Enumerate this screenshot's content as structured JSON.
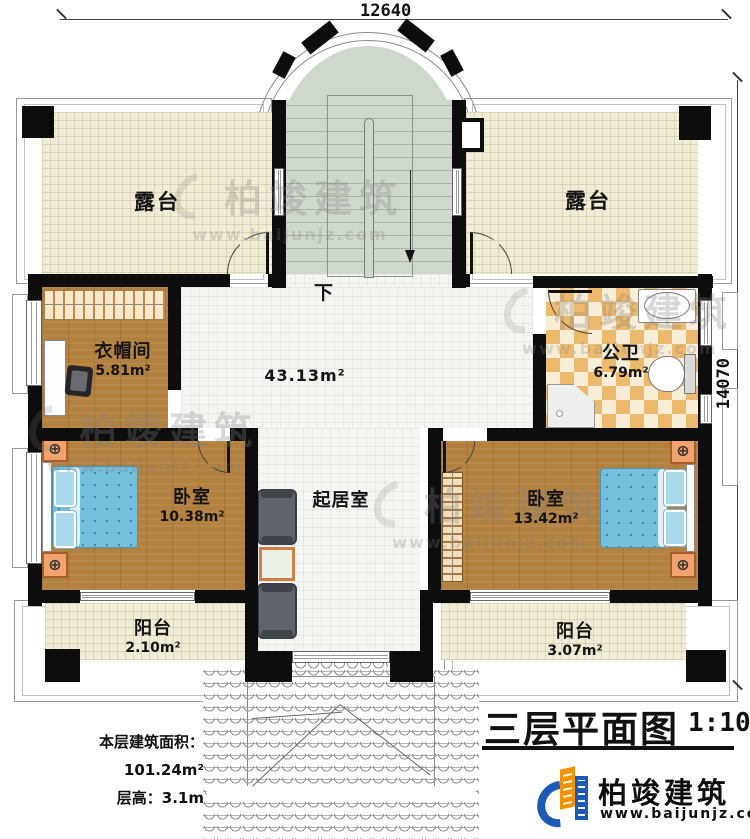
{
  "dimensions": {
    "width_top": "12640",
    "height_right": "14070"
  },
  "stairs": {
    "down_label": "下"
  },
  "rooms": {
    "terrace_left": {
      "label": "露台"
    },
    "terrace_right": {
      "label": "露台"
    },
    "cloakroom": {
      "label": "衣帽间",
      "area": "5.81m²"
    },
    "hall": {
      "area": "43.13m²"
    },
    "bathroom": {
      "label": "公卫",
      "area": "6.79m²"
    },
    "bedroom_left": {
      "label": "卧室",
      "area": "10.38m²"
    },
    "living_room": {
      "label": "起居室"
    },
    "bedroom_right": {
      "label": "卧室",
      "area": "13.42m²"
    },
    "balcony_left": {
      "label": "阳台",
      "area": "2.10m²"
    },
    "balcony_right": {
      "label": "阳台",
      "area": "3.07m²"
    }
  },
  "info": {
    "area_label": "本层建筑面积：",
    "area_value": "101.24m²",
    "height_label": "层高：",
    "height_value": "3.1m"
  },
  "title": {
    "text": "三层平面图",
    "scale": "1:100"
  },
  "brand": {
    "name": "柏竣建筑",
    "url": "www.baijunjz.com"
  },
  "watermark": {
    "name": "柏竣建筑",
    "url": "www.baijunjz.com"
  },
  "colors": {
    "wall": "#0d0d0d",
    "brand_blue": "#1b5bb5",
    "brand_orange": "#f39200",
    "wood": "#b2813f",
    "bed_blue": "#74bede",
    "tile_orange": "#edb96d",
    "stair_green": "#cfd8cc",
    "terrace_beige": "#f1ecd6"
  }
}
